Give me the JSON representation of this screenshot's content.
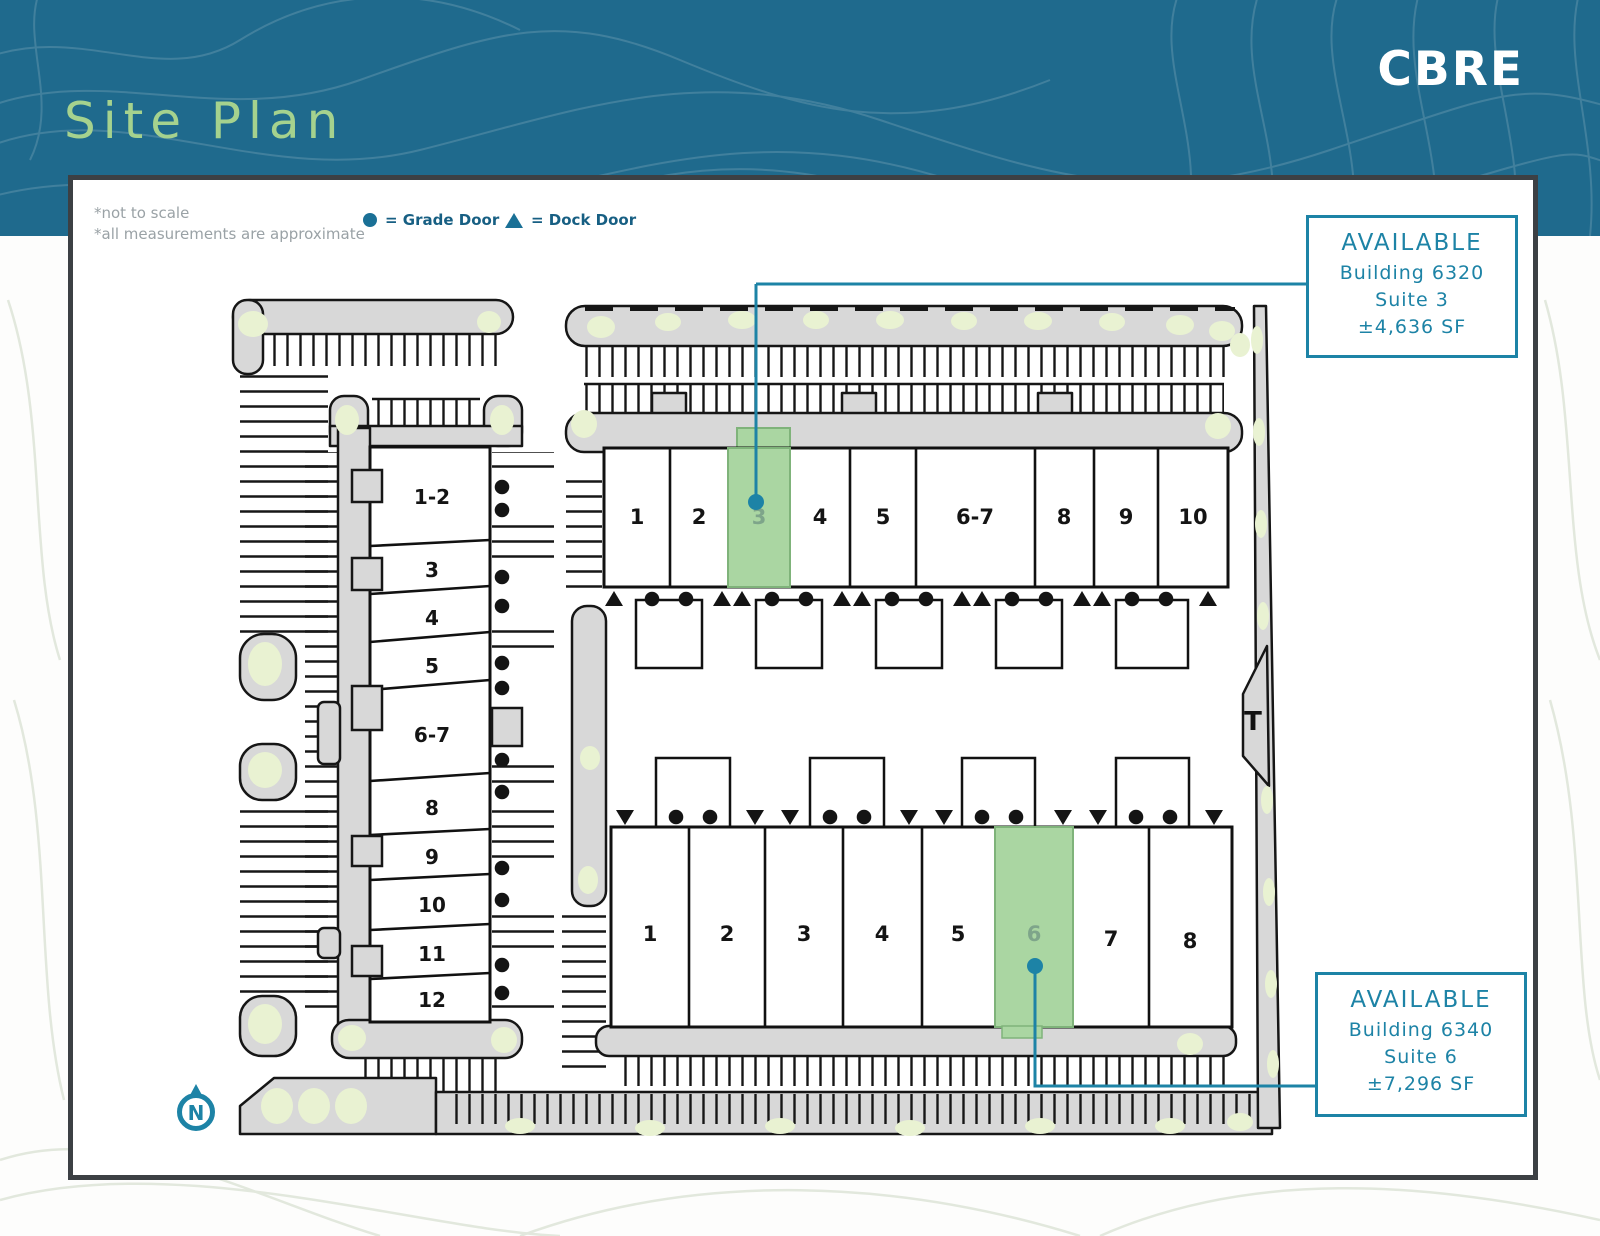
{
  "header": {
    "title": "Site Plan",
    "logo": "CBRE"
  },
  "notes": {
    "line1": "*not to scale",
    "line2": "*all measurements are approximate"
  },
  "legend": {
    "grade_label": "= Grade Door",
    "dock_label": "= Dock Door"
  },
  "callouts": [
    {
      "status": "AVAILABLE",
      "building": "Building 6320",
      "suite": "Suite 3",
      "size": "±4,636 SF"
    },
    {
      "status": "AVAILABLE",
      "building": "Building 6340",
      "suite": "Suite 6",
      "size": "±7,296 SF"
    }
  ],
  "buildings": {
    "west": {
      "suites": [
        "1-2",
        "3",
        "4",
        "5",
        "6-7",
        "8",
        "9",
        "10",
        "11",
        "12"
      ]
    },
    "north": {
      "suites": [
        "1",
        "2",
        "3",
        "4",
        "5",
        "6-7",
        "8",
        "9",
        "10"
      ],
      "highlighted_suite": "3"
    },
    "south": {
      "suites": [
        "1",
        "2",
        "3",
        "4",
        "5",
        "6",
        "7",
        "8"
      ],
      "highlighted_suite": "6"
    }
  },
  "compass": {
    "label": "N"
  },
  "transformer": {
    "label": "T"
  },
  "colors": {
    "banner": "#1f6a8d",
    "accent": "#1d83a6",
    "title_green": "#a5d28e",
    "available_green": "#aad6a2",
    "pavement": "#d8d8d8",
    "landscape": "#e9f2d2",
    "legend_teal": "#1a7096",
    "note_gray": "#9aa2a6"
  }
}
